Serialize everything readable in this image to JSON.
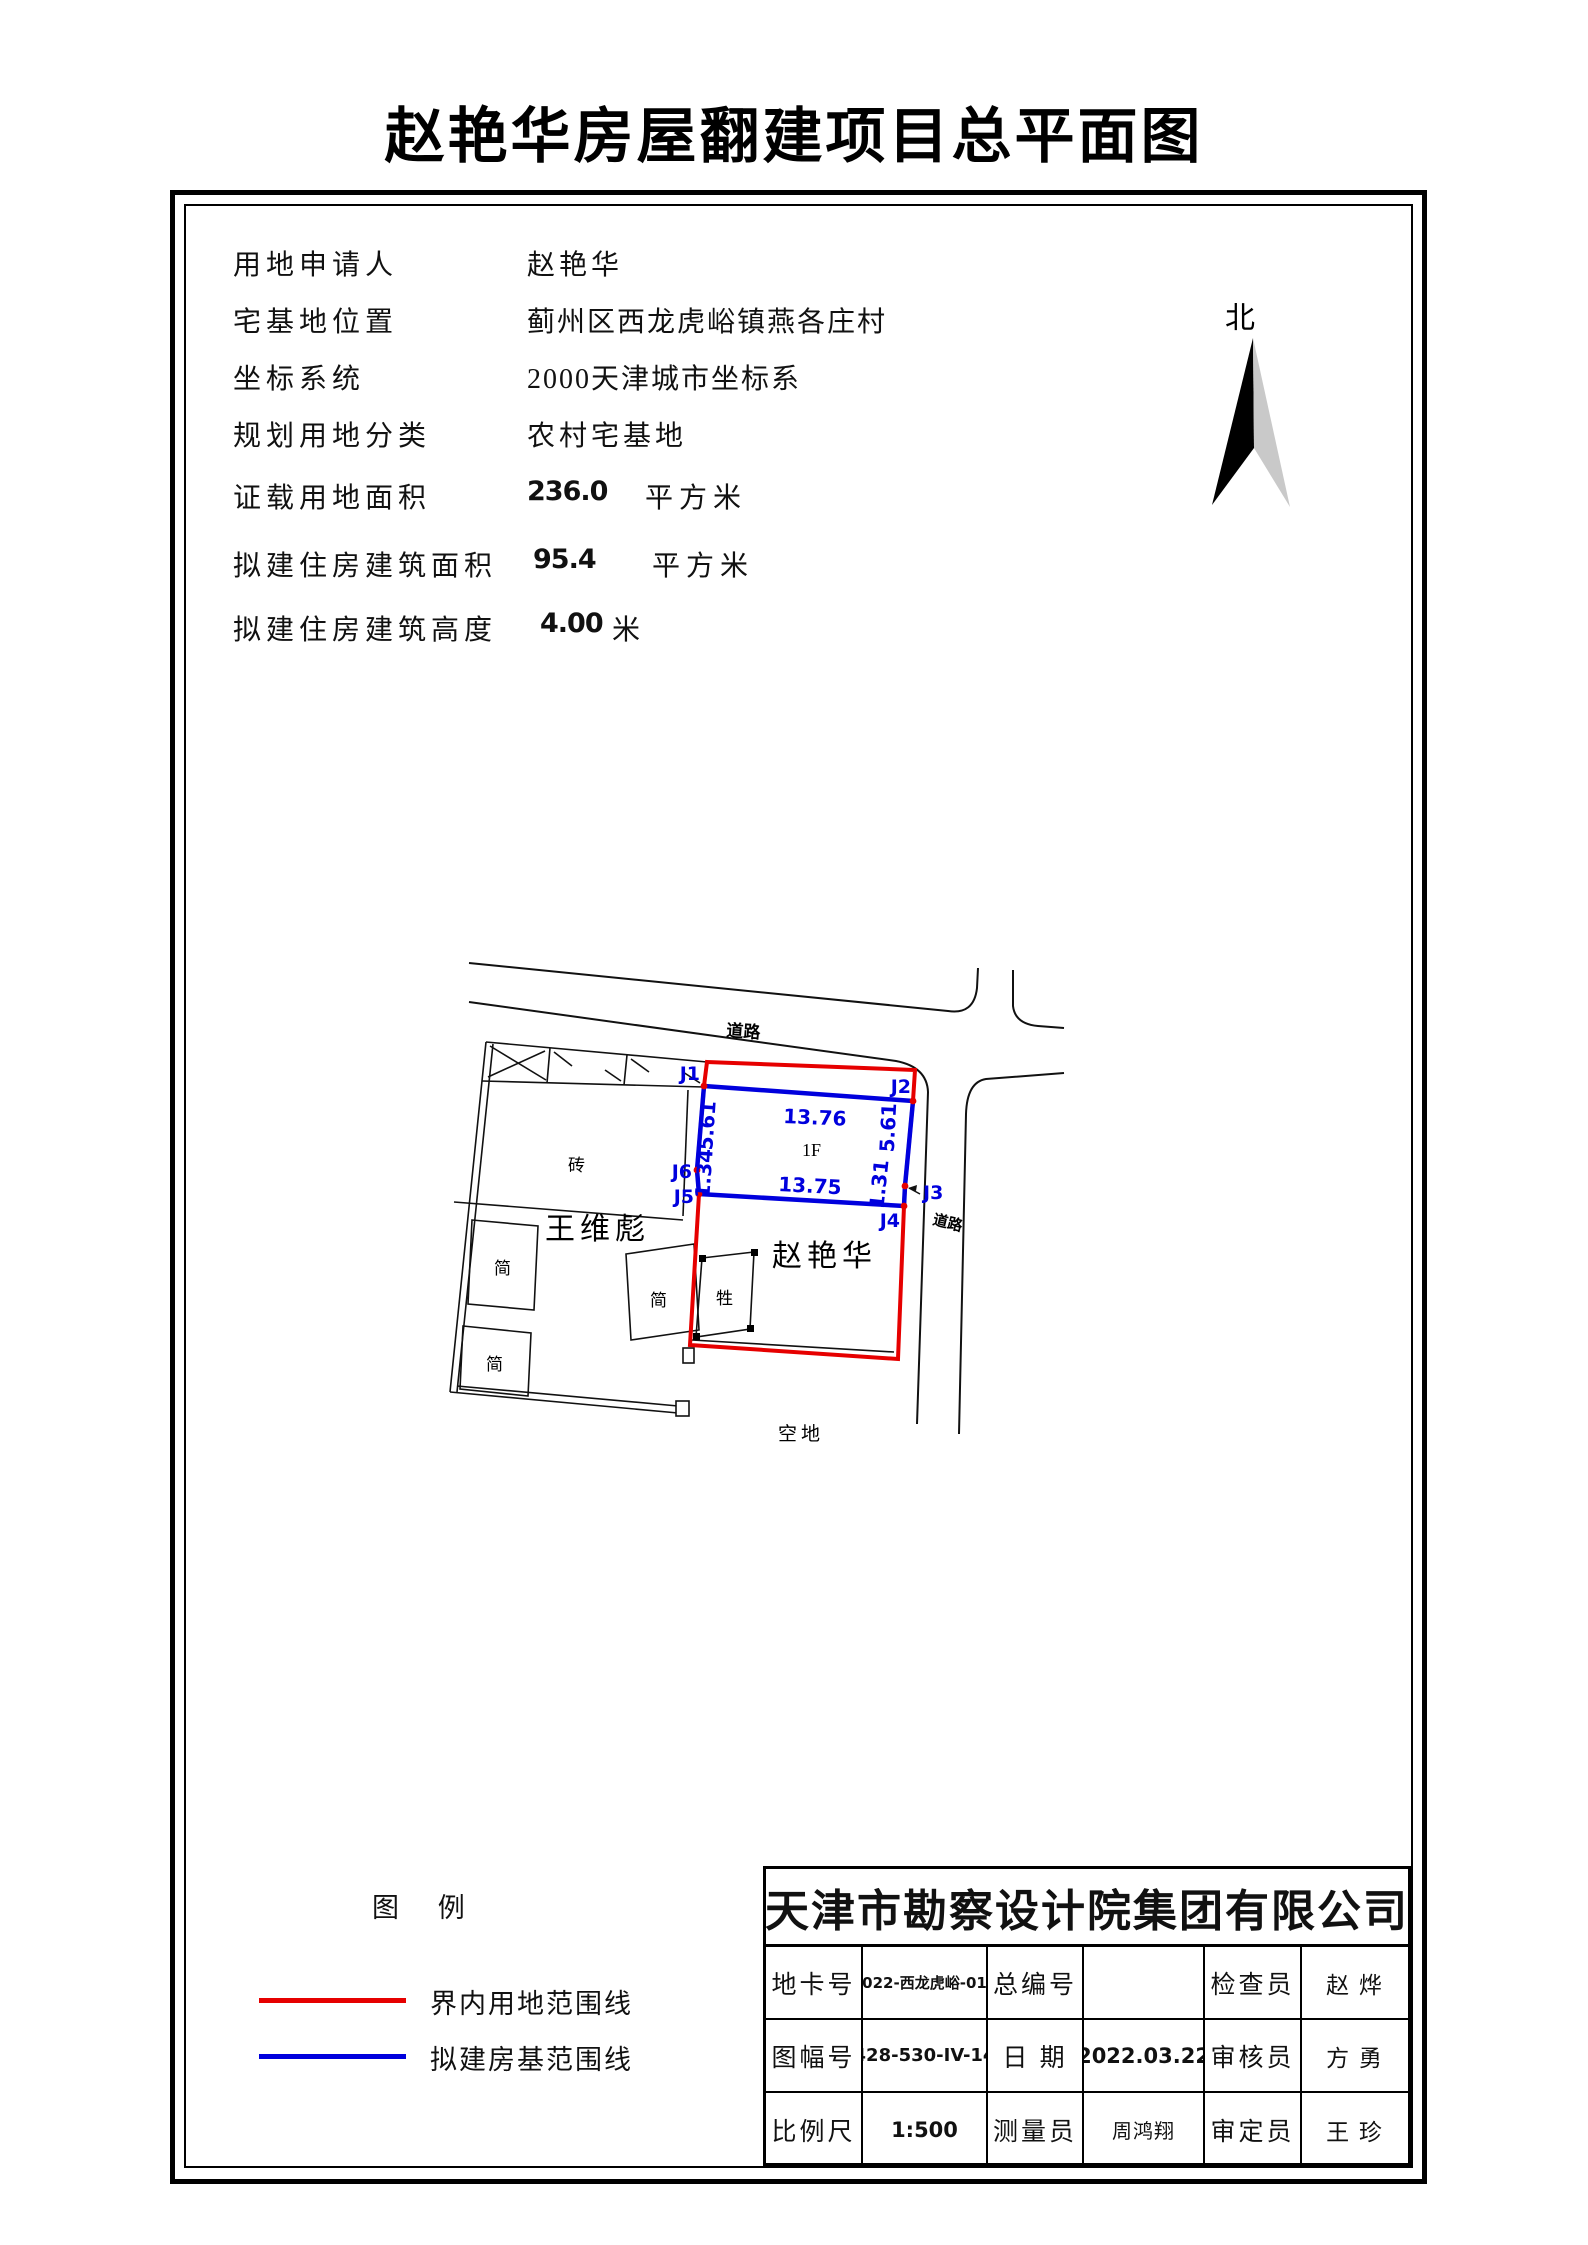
{
  "page_title": "赵艳华房屋翻建项目总平面图",
  "north_label": "北",
  "info_rows": [
    {
      "label": "用地申请人",
      "value": "赵艳华",
      "unit": ""
    },
    {
      "label": "宅基地位置",
      "value": "蓟州区西龙虎峪镇燕各庄村",
      "unit": ""
    },
    {
      "label": "坐标系统",
      "value": "2000天津城市坐标系",
      "unit": ""
    },
    {
      "label": "规划用地分类",
      "value": "农村宅基地",
      "unit": ""
    },
    {
      "label": "证载用地面积",
      "value": "236.0",
      "unit": "平方米"
    },
    {
      "label": "拟建住房建筑面积",
      "value": "95.4",
      "unit": "平方米"
    },
    {
      "label": "拟建住房建筑高度",
      "value": "4.00",
      "unit": "米"
    }
  ],
  "plan": {
    "road_top": "道路",
    "road_right": "道路",
    "neighbor": "王维彪",
    "owner": "赵艳华",
    "empty_land": "空地",
    "bldg_brick": "砖",
    "bldg_simple": "简",
    "bldg_livestock": "牲",
    "floor": "1F",
    "j1": "J1",
    "j2": "J2",
    "j3": "J3",
    "j4": "J4",
    "j5": "J5",
    "j6": "J6",
    "dim_top": "13.76",
    "dim_bottom": "13.75",
    "dim_left_upper": "5.61",
    "dim_left_lower": "1.34",
    "dim_right_upper": "5.61",
    "dim_right_lower": "1.31"
  },
  "colors": {
    "boundary_red": "#e60000",
    "house_blue": "#0000dd"
  },
  "legend": {
    "title": "图 例",
    "item_red": "界内用地范围线",
    "item_blue": "拟建房基范围线"
  },
  "titleblock": {
    "company": "天津市勘察设计院集团有限公司",
    "r1l1": "地卡号",
    "r1v1": "2022-西龙虎峪-016",
    "r1l2": "总编号",
    "r1v2": "",
    "r1l3": "检查员",
    "r1v3": "赵 烨",
    "r2l1": "图幅号",
    "r2v1": "428-530-IV-14",
    "r2l2": "日 期",
    "r2v2": "2022.03.22",
    "r2l3": "审核员",
    "r2v3": "方 勇",
    "r3l1": "比例尺",
    "r3v1": "1:500",
    "r3l2": "测量员",
    "r3v2": "周鸿翔",
    "r3l3": "审定员",
    "r3v3": "王 珍"
  }
}
